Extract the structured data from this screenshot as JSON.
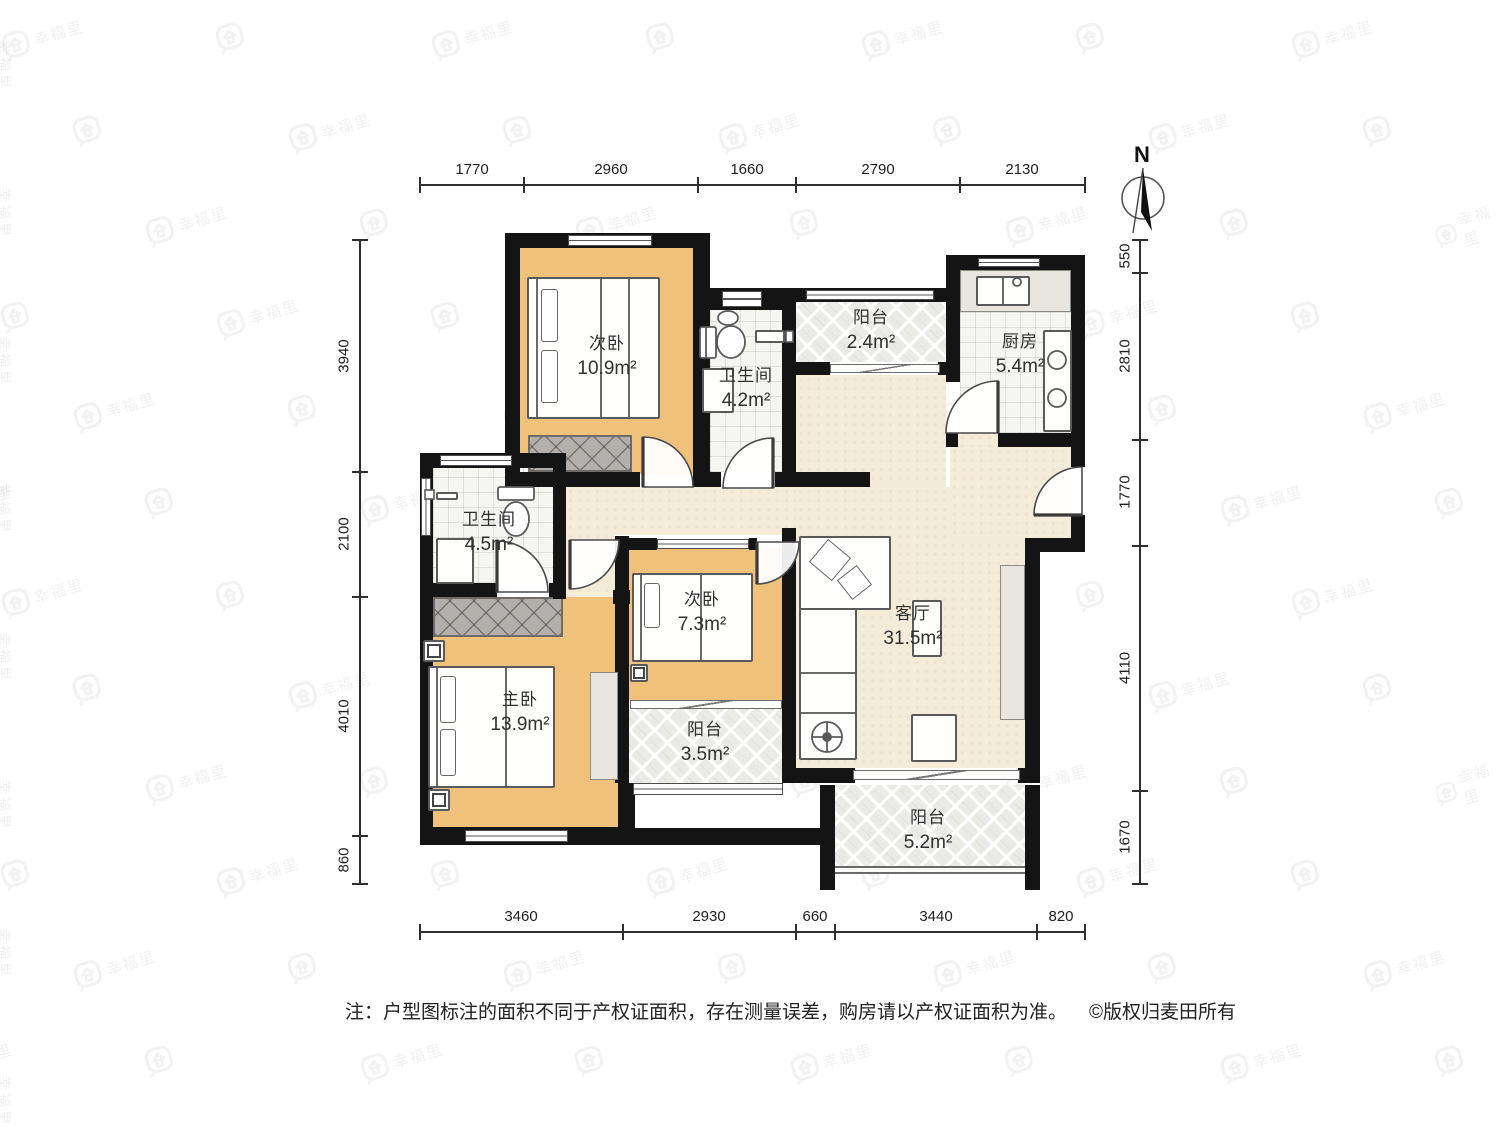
{
  "compass": {
    "north_label": "N"
  },
  "rooms": [
    {
      "id": "bedroom-top",
      "name": "次卧",
      "area": "10.9m²"
    },
    {
      "id": "bathroom-top",
      "name": "卫生间",
      "area": "4.2m²"
    },
    {
      "id": "balcony-top",
      "name": "阳台",
      "area": "2.4m²"
    },
    {
      "id": "kitchen",
      "name": "厨房",
      "area": "5.4m²"
    },
    {
      "id": "bathroom-left",
      "name": "卫生间",
      "area": "4.5m²"
    },
    {
      "id": "bedroom-middle",
      "name": "次卧",
      "area": "7.3m²"
    },
    {
      "id": "living-room",
      "name": "客厅",
      "area": "31.5m²"
    },
    {
      "id": "master-bedroom",
      "name": "主卧",
      "area": "13.9m²"
    },
    {
      "id": "balcony-middle",
      "name": "阳台",
      "area": "3.5m²"
    },
    {
      "id": "balcony-bottom",
      "name": "阳台",
      "area": "5.2m²"
    }
  ],
  "dimensions": {
    "top": [
      "1770",
      "2960",
      "1660",
      "2790",
      "2130"
    ],
    "bottom": [
      "3460",
      "2930",
      "660",
      "3440",
      "820"
    ],
    "left": [
      "3940",
      "2100",
      "4010",
      "860"
    ],
    "right": [
      "550",
      "2810",
      "1770",
      "4110",
      "1670"
    ]
  },
  "note": {
    "text": "注：户型图标注的面积不同于产权证面积，存在测量误差，购房请以产权证面积为准。",
    "copyright": "©版权归麦田所有"
  },
  "watermark": {
    "text": "幸福里"
  },
  "colors": {
    "wall": "#141414",
    "bedroom_fill": "#f0c17a",
    "public_fill": "#f4ebd9",
    "wet_fill": "#f5f5f2",
    "balcony_fill": "#eaeae6",
    "wardrobe_fill": "#b3b0ac",
    "watermark": "#8d8d8d"
  }
}
